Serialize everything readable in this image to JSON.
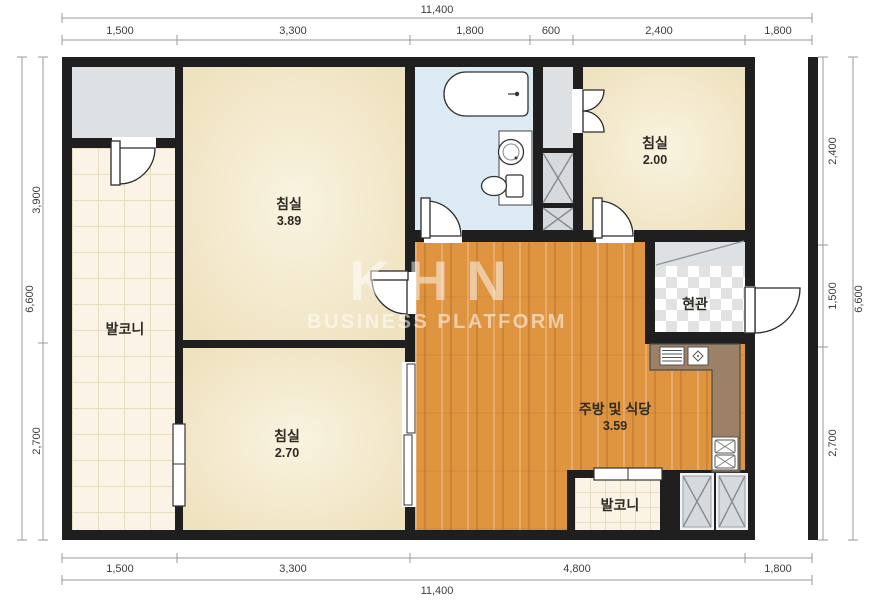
{
  "watermark": {
    "logo": "KHN",
    "subtitle": "BUSINESS PLATFORM"
  },
  "rooms": {
    "bedroom_main": {
      "name": "침실",
      "area": "3.89"
    },
    "bedroom_upper_right": {
      "name": "침실",
      "area": "2.00"
    },
    "bedroom_lower": {
      "name": "침실",
      "area": "2.70"
    },
    "kitchen_dining": {
      "name": "주방 및 식당",
      "area": "3.59"
    },
    "balcony_left": {
      "name": "발코니"
    },
    "balcony_bottom": {
      "name": "발코니"
    },
    "entrance": {
      "name": "현관"
    }
  },
  "dimensions": {
    "top": {
      "total": "11,400",
      "segments": [
        "1,500",
        "3,300",
        "1,800",
        "600",
        "2,400",
        "1,800"
      ]
    },
    "bottom": {
      "total": "11,400",
      "segments": [
        "1,500",
        "3,300",
        "4,800",
        "1,800"
      ]
    },
    "left": {
      "total": "6,600",
      "segments": [
        "3,900",
        "2,700"
      ]
    },
    "right": {
      "total": "6,600",
      "segments": [
        "2,400",
        "1,500",
        "2,700"
      ]
    }
  },
  "colors": {
    "wall": "#1f1f1f",
    "wood_floor": "#df9440",
    "bathroom": "#dcebf3",
    "bedroom": "#f3ead0",
    "counter": "#9c8166"
  }
}
